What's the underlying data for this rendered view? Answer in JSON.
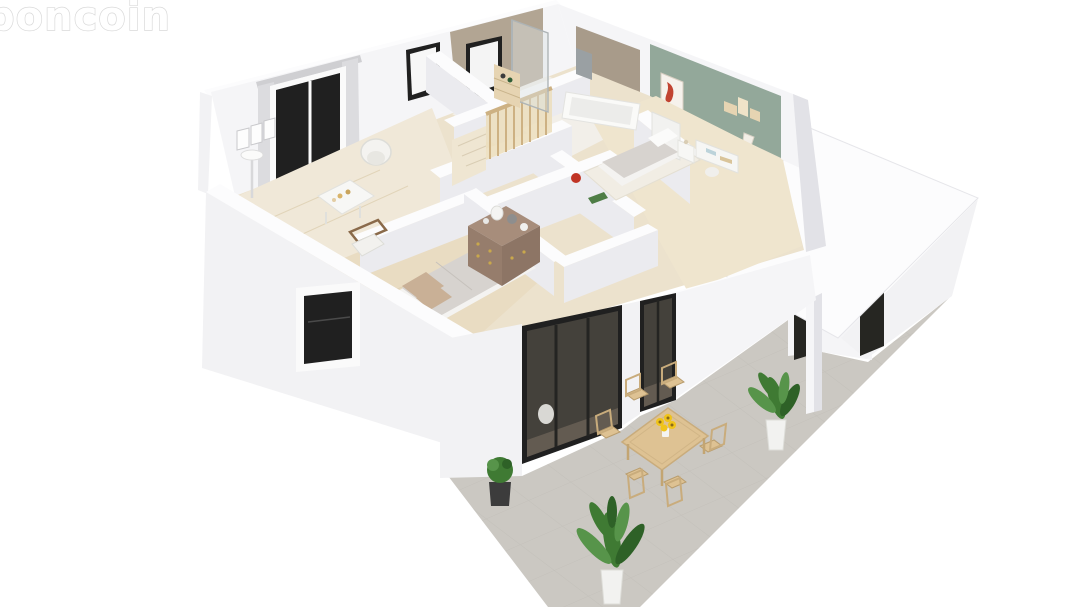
{
  "watermark": {
    "text": "boncoin"
  },
  "scene": {
    "type": "isometric-3d-floor-plan",
    "view": "cutaway single-storey house with furnished rooms, covered patio, garage block and tiled terrace with outdoor dining set"
  },
  "colors": {
    "background": "#ffffff",
    "terrace": "#cbc8c2",
    "terrace_line": "#bdbab4",
    "floor_base": "#ece2cd",
    "floor_office": "#f0e8d8",
    "floor_master": "#e9dcc2",
    "floor_bedroom": "#efe5ce",
    "floor_bath": "#f2efe9",
    "plank_line": "#ded0b2",
    "accent_green": "#93a89a",
    "tile_tan": "#b2a593",
    "tile_tan_dark": "#a89b8a",
    "window_dark": "#202020",
    "glass_dark": "#44413b",
    "glass_reflect": "#6b6257",
    "curtain": "#dcdcdf",
    "wood_furniture": "#dec293",
    "wood_edge": "#c9ac7c",
    "rail_wood": "#cdb183",
    "rail_fill": "#ecdfbf",
    "dresser_top": "#a78d7b",
    "dresser_front": "#967d6c",
    "dresser_side": "#8d7565",
    "knob_gold": "#c9a84c",
    "duvet_gray": "#d7d3cf",
    "pillow_tan": "#c9b096",
    "bed_white": "#f4f3f1",
    "rug_white": "#f1ede4",
    "plant_green": "#3f7a33",
    "plant_light": "#57944a",
    "plant_dark": "#2e6127",
    "pot_white": "#f2f2f0",
    "pot_dark": "#3c3c3c",
    "sunflower": "#f0c419",
    "sunflower_core": "#8a6a1a",
    "art_red": "#c14432",
    "red_object": "#c03425",
    "green_object": "#4e7d46",
    "radiator": "#9aa0a3",
    "shower_glass": "#dce2e3",
    "shower_frame": "#aeb4b6",
    "opening_dark": "#262622",
    "tub_inner": "#ececea",
    "shelf_tan": "#e6d4b2"
  }
}
